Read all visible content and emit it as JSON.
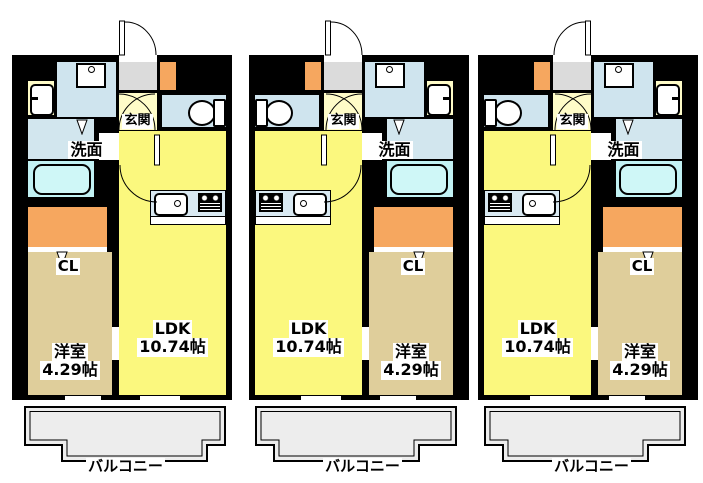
{
  "figure": "apartment-floor-plans",
  "colors": {
    "wall": "#000000",
    "background": "#ffffff",
    "ldk_fill": "#fbf87e",
    "bedroom_fill": "#dfce9b",
    "closet_fill": "#f6a75f",
    "entrance_fill": "#dbdbdb",
    "hall_fill": "#fffcc8",
    "sanitary_fill": "#cfe4ee",
    "bathtub_fill": "#c2f2f4",
    "kitchen_counter_fill": "#d9e9f2",
    "balcony_fill": "#ededed"
  },
  "units": [
    {
      "name": "unit-1",
      "entrance_label": "玄関",
      "washroom_label": "洗面",
      "closet_label": "CL",
      "ldk_label": "LDK",
      "ldk_size": "10.74帖",
      "bedroom_label": "洋室",
      "bedroom_size": "4.29帖",
      "balcony_label": "バルコニー"
    },
    {
      "name": "unit-2",
      "entrance_label": "玄関",
      "washroom_label": "洗面",
      "closet_label": "CL",
      "ldk_label": "LDK",
      "ldk_size": "10.74帖",
      "bedroom_label": "洋室",
      "bedroom_size": "4.29帖",
      "balcony_label": "バルコニー"
    },
    {
      "name": "unit-3",
      "entrance_label": "玄関",
      "washroom_label": "洗面",
      "closet_label": "CL",
      "ldk_label": "LDK",
      "ldk_size": "10.74帖",
      "bedroom_label": "洋室",
      "bedroom_size": "4.29帖",
      "balcony_label": "バルコニー"
    }
  ]
}
